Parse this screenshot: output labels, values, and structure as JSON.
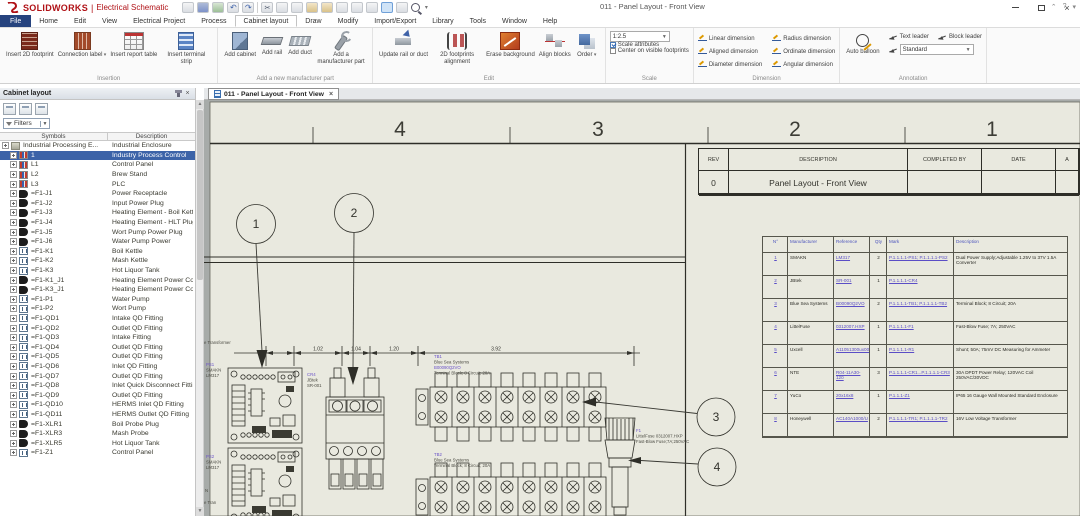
{
  "colors": {
    "accent_blue": "#3c63a8",
    "link_purple": "#5b4ec6",
    "brand_red": "#b01116",
    "sheet": "#e9e9df",
    "selected_row": "#3c63a8"
  },
  "app": {
    "brand": "SOLIDWORKS",
    "separator": "|",
    "product": "Electrical Schematic",
    "window_title": "011 - Panel Layout - Front View",
    "qat": [
      {
        "n": "window"
      },
      {
        "n": "save"
      },
      {
        "n": "image"
      },
      {
        "n": "undo"
      },
      {
        "n": "redo"
      },
      {
        "n": "sep"
      },
      {
        "n": "cut"
      },
      {
        "n": "copy"
      },
      {
        "n": "copy2"
      },
      {
        "n": "paste"
      },
      {
        "n": "paste2"
      },
      {
        "n": "format"
      },
      {
        "n": "pin1"
      },
      {
        "n": "pin2"
      },
      {
        "n": "zoomsel"
      },
      {
        "n": "leader"
      },
      {
        "n": "search"
      },
      {
        "n": "caret"
      }
    ]
  },
  "menu": {
    "tabs": [
      {
        "label": "File",
        "cls": "file"
      },
      {
        "label": "Home"
      },
      {
        "label": "Edit"
      },
      {
        "label": "View"
      },
      {
        "label": "Electrical Project"
      },
      {
        "label": "Process"
      },
      {
        "label": "Cabinet layout",
        "cls": "active"
      },
      {
        "label": "Draw"
      },
      {
        "label": "Modify"
      },
      {
        "label": "Import/Export"
      },
      {
        "label": "Library"
      },
      {
        "label": "Tools"
      },
      {
        "label": "Window"
      },
      {
        "label": "Help"
      }
    ]
  },
  "ribbon": {
    "g1": {
      "label": "Insertion",
      "items": [
        {
          "label": "Insert 2D footprint",
          "icon": "footprint-2d"
        },
        {
          "label": "Connection label",
          "icon": "connection-label",
          "caret_cls": "caretlbl"
        },
        {
          "label": "Insert report table",
          "icon": "report-table"
        },
        {
          "label": "Insert terminal strip",
          "icon": "terminal-strip"
        }
      ]
    },
    "g2": {
      "label": "Add a new manufacturer part",
      "items": [
        {
          "label": "Add cabinet",
          "icon": "cabinet"
        },
        {
          "label": "Add rail",
          "icon": "rail"
        },
        {
          "label": "Add duct",
          "icon": "duct"
        },
        {
          "label": "Add a manufacturer part",
          "icon": "wrench"
        }
      ]
    },
    "g3": {
      "label": "Edit",
      "items": [
        {
          "label": "Update rail or duct",
          "icon": "update-rail"
        },
        {
          "label": "2D footprints alignment",
          "icon": "footprint-align"
        },
        {
          "label": "Erase background",
          "icon": "erase-bg"
        },
        {
          "label": "Align blocks",
          "icon": "align-blocks"
        },
        {
          "label": "Order",
          "icon": "order",
          "caret_cls": "caretlbl"
        }
      ]
    },
    "scale": {
      "label": "Scale",
      "value": "1:2.5",
      "attr_label": "Scale attributes",
      "center_label": "Center on visible footprints"
    },
    "dim": {
      "label": "Dimension",
      "items": [
        {
          "label": "Linear dimension"
        },
        {
          "label": "Aligned dimension"
        },
        {
          "label": "Diameter dimension"
        },
        {
          "label": "Radius dimension"
        },
        {
          "label": "Ordinate dimension"
        },
        {
          "label": "Angular dimension"
        }
      ]
    },
    "ann": {
      "label": "Annotation",
      "auto_label": "Auto balloon",
      "text_leader": "Text leader",
      "block_leader": "Block leader",
      "style_value": "Standard"
    }
  },
  "sidebar": {
    "title": "Cabinet layout",
    "filters": "Filters",
    "col_symbols": "Symbols",
    "col_description": "Description",
    "rows": [
      {
        "sym": "Industrial Processing E...",
        "desc": "Industrial Enclosure",
        "icon": "encl",
        "level": "l0"
      },
      {
        "sym": "1",
        "desc": "Industry Process Control",
        "icon": "loc",
        "level": "l1",
        "sel": "sel"
      },
      {
        "sym": "L1",
        "desc": "Control Panel",
        "icon": "loc",
        "level": "l1"
      },
      {
        "sym": "L2",
        "desc": "Brew Stand",
        "icon": "loc",
        "level": "l1"
      },
      {
        "sym": "L3",
        "desc": "PLC",
        "icon": "loc",
        "level": "l1"
      },
      {
        "sym": "=F1-J1",
        "desc": "Power Receptacle",
        "icon": "plug",
        "level": "l1"
      },
      {
        "sym": "=F1-J2",
        "desc": "Input Power Plug",
        "icon": "plug",
        "level": "l1"
      },
      {
        "sym": "=F1-J3",
        "desc": "Heating Element - Boil Kettle Pl...",
        "icon": "plug",
        "level": "l1"
      },
      {
        "sym": "=F1-J4",
        "desc": "Heating Element - HLT Plug",
        "icon": "plug",
        "level": "l1"
      },
      {
        "sym": "=F1-J5",
        "desc": "Wort Pump Power Plug",
        "icon": "plug",
        "level": "l1"
      },
      {
        "sym": "=F1-J6",
        "desc": "Water Pump Power",
        "icon": "plug",
        "level": "l1"
      },
      {
        "sym": "=F1-K1",
        "desc": "Boil Kettle",
        "icon": "box",
        "level": "l1"
      },
      {
        "sym": "=F1-K2",
        "desc": "Mash Kettle",
        "icon": "box",
        "level": "l1"
      },
      {
        "sym": "=F1-K3",
        "desc": "Hot Liquor Tank",
        "icon": "box",
        "level": "l1"
      },
      {
        "sym": "=F1-K1_J1",
        "desc": "Heating Element Power Conne...",
        "icon": "plug",
        "level": "l1"
      },
      {
        "sym": "=F1-K3_J1",
        "desc": "Heating Element Power Conne...",
        "icon": "plug",
        "level": "l1"
      },
      {
        "sym": "=F1-P1",
        "desc": "Water Pump",
        "icon": "box",
        "level": "l1"
      },
      {
        "sym": "=F1-P2",
        "desc": "Wort Pump",
        "icon": "box",
        "level": "l1"
      },
      {
        "sym": "=F1-QD1",
        "desc": "Intake QD Fitting",
        "icon": "box",
        "level": "l1"
      },
      {
        "sym": "=F1-QD2",
        "desc": "Outlet QD Fitting",
        "icon": "box",
        "level": "l1"
      },
      {
        "sym": "=F1-QD3",
        "desc": "Intake Fitting",
        "icon": "box",
        "level": "l1"
      },
      {
        "sym": "=F1-QD4",
        "desc": "Outlet QD Fitting",
        "icon": "box",
        "level": "l1"
      },
      {
        "sym": "=F1-QD5",
        "desc": "Outlet QD Fitting",
        "icon": "box",
        "level": "l1"
      },
      {
        "sym": "=F1-QD6",
        "desc": "Inlet QD Fitting",
        "icon": "box",
        "level": "l1"
      },
      {
        "sym": "=F1-QD7",
        "desc": "Outlet QD Fitting",
        "icon": "box",
        "level": "l1"
      },
      {
        "sym": "=F1-QD8",
        "desc": "Inlet Quick Disconnect Fitting",
        "icon": "box",
        "level": "l1"
      },
      {
        "sym": "=F1-QD9",
        "desc": "Outlet QD Fitting",
        "icon": "box",
        "level": "l1"
      },
      {
        "sym": "=F1-QD10",
        "desc": "HERMS Inlet QD Fitting",
        "icon": "box",
        "level": "l1"
      },
      {
        "sym": "=F1-QD11",
        "desc": "HERMS Outlet QD Fitting",
        "icon": "box",
        "level": "l1"
      },
      {
        "sym": "=F1-XLR1",
        "desc": "Boil Probe Plug",
        "icon": "plug",
        "level": "l1"
      },
      {
        "sym": "=F1-XLR3",
        "desc": "Mash Probe",
        "icon": "plug",
        "level": "l1"
      },
      {
        "sym": "=F1-XLR5",
        "desc": "Hot Liquor Tank",
        "icon": "plug",
        "level": "l1"
      },
      {
        "sym": "=F1-Z1",
        "desc": "Control Panel",
        "icon": "box",
        "level": "l1"
      }
    ]
  },
  "tab": {
    "label": "011 - Panel Layout - Front View"
  },
  "drawing": {
    "zones": {
      "z4": "4",
      "z3": "3",
      "z2": "2",
      "z1": "1"
    },
    "title_block": {
      "h_rev": "REV",
      "h_desc": "DESCRIPTION",
      "h_comp": "COMPLETED BY",
      "h_date": "DATE",
      "h_appr": "A",
      "rev": "0",
      "description": "Panel Layout - Front View"
    },
    "dims": {
      "d1": "1.02",
      "d2": "1.04",
      "d3": "1.20",
      "d4": "3.92"
    },
    "balloons": {
      "b1": "1",
      "b2": "2",
      "b3": "3",
      "b4": "4"
    },
    "labels": {
      "tb1": {
        "tag": "TB1",
        "mfr": "Blue Sea Systems",
        "ref": "B00090Q2VO",
        "desc": "Terminal Block; 8 Circuit; 20A"
      },
      "tb2": {
        "tag": "TB2",
        "mfr": "Blue Sea Systems",
        "desc": "Terminal Block; 8 Circuit; 20A"
      },
      "f1": {
        "tag": "F1",
        "ref": "LittelFuse 0312007.HXP",
        "desc": "Fast-Blow Fuse;7A;250VAC"
      },
      "cr": {
        "tag": "CR4",
        "mfr": "JBtek",
        "ref": "SR-001"
      },
      "ps1": {
        "tag": "PS1",
        "mfr": "SMAKN",
        "ref": "LM317"
      },
      "ps2": {
        "tag": "PS2",
        "mfr": "SMAKN",
        "ref": "LM317"
      },
      "fragments": {
        "f1": "e Transformer",
        "f2": "N",
        "f3": "e Tran"
      }
    }
  },
  "bom": {
    "headers": {
      "no": "N°",
      "mfr": "Manufacturer",
      "ref": "Reference",
      "qty": "Qty",
      "mark": "Mark",
      "desc": "Description"
    },
    "rows": [
      {
        "no": "1",
        "mfr": "SMAKN",
        "ref": "LM317",
        "qty": "2",
        "mark": "P.1.1.1.1-PS1; P.1.1.1.1-PS2",
        "desc": "Dual Power Supply;Adjustable 1.25V to 37V 1.5A Converter"
      },
      {
        "no": "2",
        "mfr": "JBtek",
        "ref": "SR-001",
        "qty": "1",
        "mark": "P.1.1.1.1-CR4",
        "desc": ""
      },
      {
        "no": "3",
        "mfr": "Blue Sea Systems",
        "ref": "B00090Q2VO",
        "qty": "2",
        "mark": "P.1.1.1.1-TB1; P.1.1.1.1-TB2",
        "desc": "Terminal Block; 8 Circuit; 20A"
      },
      {
        "no": "4",
        "mfr": "LittelFuse",
        "ref": "0312007.HXP",
        "qty": "1",
        "mark": "P.1.1.1.1-F1",
        "desc": "Fast-Blow Fuse; 7A; 250VAC"
      },
      {
        "no": "5",
        "mfr": "Uxcell",
        "ref": "A11051300ux0044",
        "qty": "1",
        "mark": "P.1.1.1.1-R1",
        "desc": "Shunt; 50A; 75mV DC Measuring for Ammeter"
      },
      {
        "no": "6",
        "mfr": "NTE",
        "ref": "R04-11A30-120",
        "qty": "3",
        "mark": "P.1.1.1.1-CR1...P.1.1.1.1-CR3",
        "desc": "30A DPDT Power Relay; 120VAC Coil 250VAC/30VDC"
      },
      {
        "no": "7",
        "mfr": "YuCo",
        "ref": "20x16x8",
        "qty": "1",
        "mark": "P.1.1.1-Z1",
        "desc": "IP65 16 Gauge Wall Mounted Standard Enclosure"
      },
      {
        "no": "8",
        "mfr": "Honeywell",
        "ref": "AC140A1000/U",
        "qty": "2",
        "mark": "P.1.1.1.1-TR1; P.1.1.1.1-TR2",
        "desc": "16V Low Voltage Transformer"
      }
    ]
  }
}
